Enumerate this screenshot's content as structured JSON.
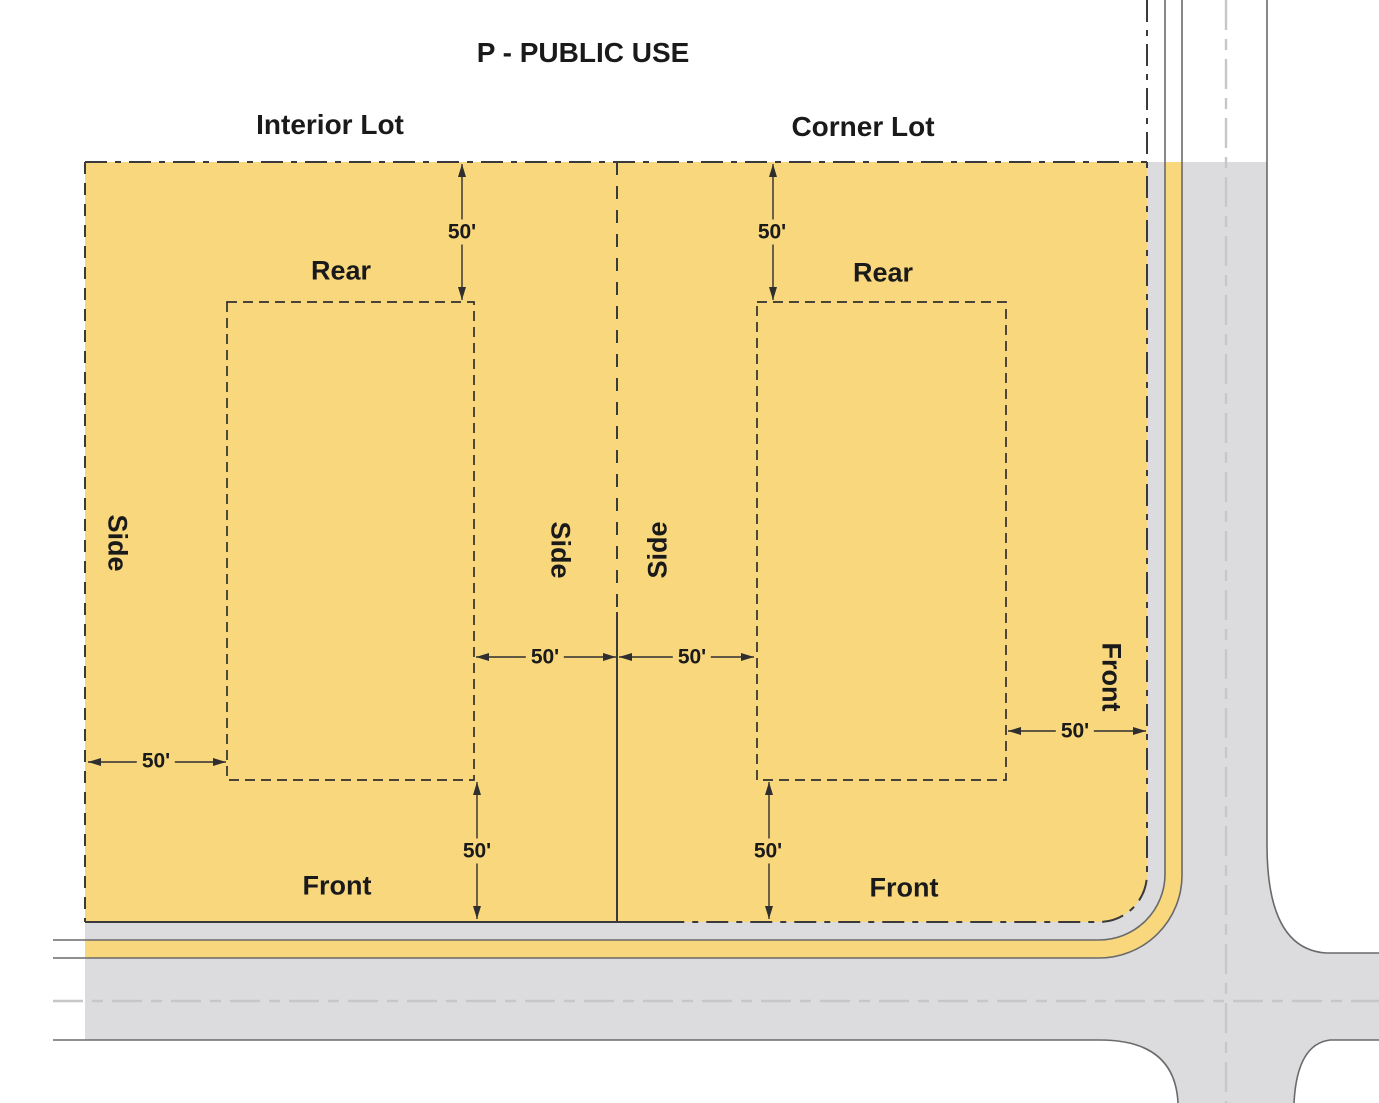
{
  "title": "P - PUBLIC USE",
  "lots": {
    "interior": {
      "name": "Interior Lot",
      "rear_label": "Rear",
      "side_outer_label": "Side",
      "side_inner_label": "Side",
      "front_label": "Front",
      "rear_setback": "50'",
      "side_outer_setback": "50'",
      "side_inner_setback": "50'",
      "front_setback": "50'"
    },
    "corner": {
      "name": "Corner Lot",
      "rear_label": "Rear",
      "side_label": "Side",
      "front_street_label": "Front",
      "front_label": "Front",
      "rear_setback": "50'",
      "side_setback": "50'",
      "front_street_setback": "50'",
      "front_setback": "50'"
    }
  },
  "colors": {
    "lot_fill": "#F9D77D",
    "road_fill": "#DCDCDE",
    "boundary_line": "#3A3A3C",
    "detail_line": "#2F2F30",
    "road_edge": "#6A6A6C",
    "centerline": "#C7C7C9",
    "text": "#1A1A1A",
    "page_bg": "#FFFFFF"
  }
}
